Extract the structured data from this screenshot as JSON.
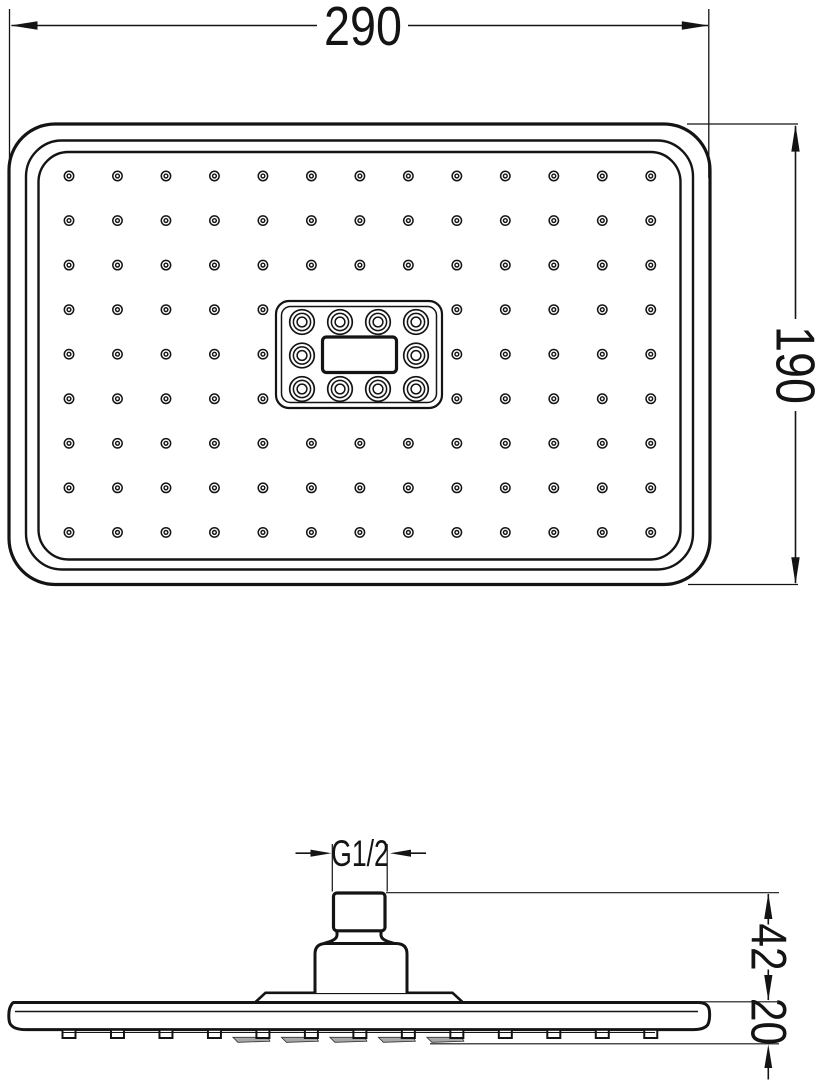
{
  "page": {
    "title": "Shower head dimensional drawing"
  },
  "dimensions": {
    "width_mm": "290",
    "height_mm": "190",
    "thread": "G1/2",
    "connector_height_mm": "42",
    "head_thickness_mm": "20"
  },
  "front_view": {
    "small_nozzle_grid": {
      "cols": 13,
      "rows": 9,
      "x0": 69,
      "y0": 176,
      "dx": 48.48,
      "dy": 44.55,
      "skip_cols": [
        5,
        6,
        7
      ],
      "skip_rows": [
        3,
        4,
        5
      ]
    },
    "small_nozzle_count": 108,
    "large_nozzle_count": 10,
    "large_nozzles": [
      [
        302,
        322
      ],
      [
        340,
        322
      ],
      [
        378,
        322
      ],
      [
        416,
        322
      ],
      [
        302,
        355.5
      ],
      [
        416,
        355.5
      ],
      [
        302,
        389
      ],
      [
        340,
        389
      ],
      [
        378,
        389
      ],
      [
        416,
        389
      ]
    ]
  },
  "side_view": {
    "teeth_count": 13,
    "plate_cols": [
      4,
      5,
      6,
      7,
      8
    ]
  },
  "colors": {
    "line": "#141414",
    "background": "#ffffff",
    "plate_shade": "#a8a8a8"
  }
}
